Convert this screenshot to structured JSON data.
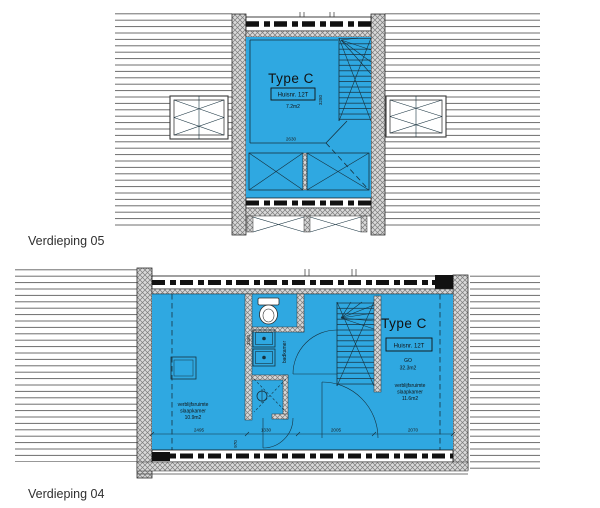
{
  "colors": {
    "room_fill": "#2FA8E1",
    "drawing_line": "#17323F",
    "wall_fill": "#d9d9d9",
    "dash_band": "#111111",
    "label_text": "#2f2f2f"
  },
  "floor5": {
    "label": "Verdieping 05",
    "type": "Type C",
    "huisnr": "Huisnr. 12T",
    "area": "7.2m2",
    "dim_width": "2630",
    "dim_height": "3280"
  },
  "floor4": {
    "label": "Verdieping 04",
    "type": "Type C",
    "huisnr": "Huisnr. 12T",
    "go": "GO",
    "go_area": "32.3m2",
    "bathroom_label": "badkamer",
    "bedroom_right": {
      "l1": "verblijfsruimte",
      "l2": "slaapkamer",
      "l3": "11.6m2"
    },
    "bedroom_left": {
      "l1": "verblijfsruimte",
      "l2": "slaapkamer",
      "l3": "10.9m2"
    },
    "dims": {
      "d2495": "2495",
      "d1330": "1330",
      "d2005": "2005",
      "d2070": "2070",
      "d970": "970",
      "d3380": "3380"
    }
  }
}
